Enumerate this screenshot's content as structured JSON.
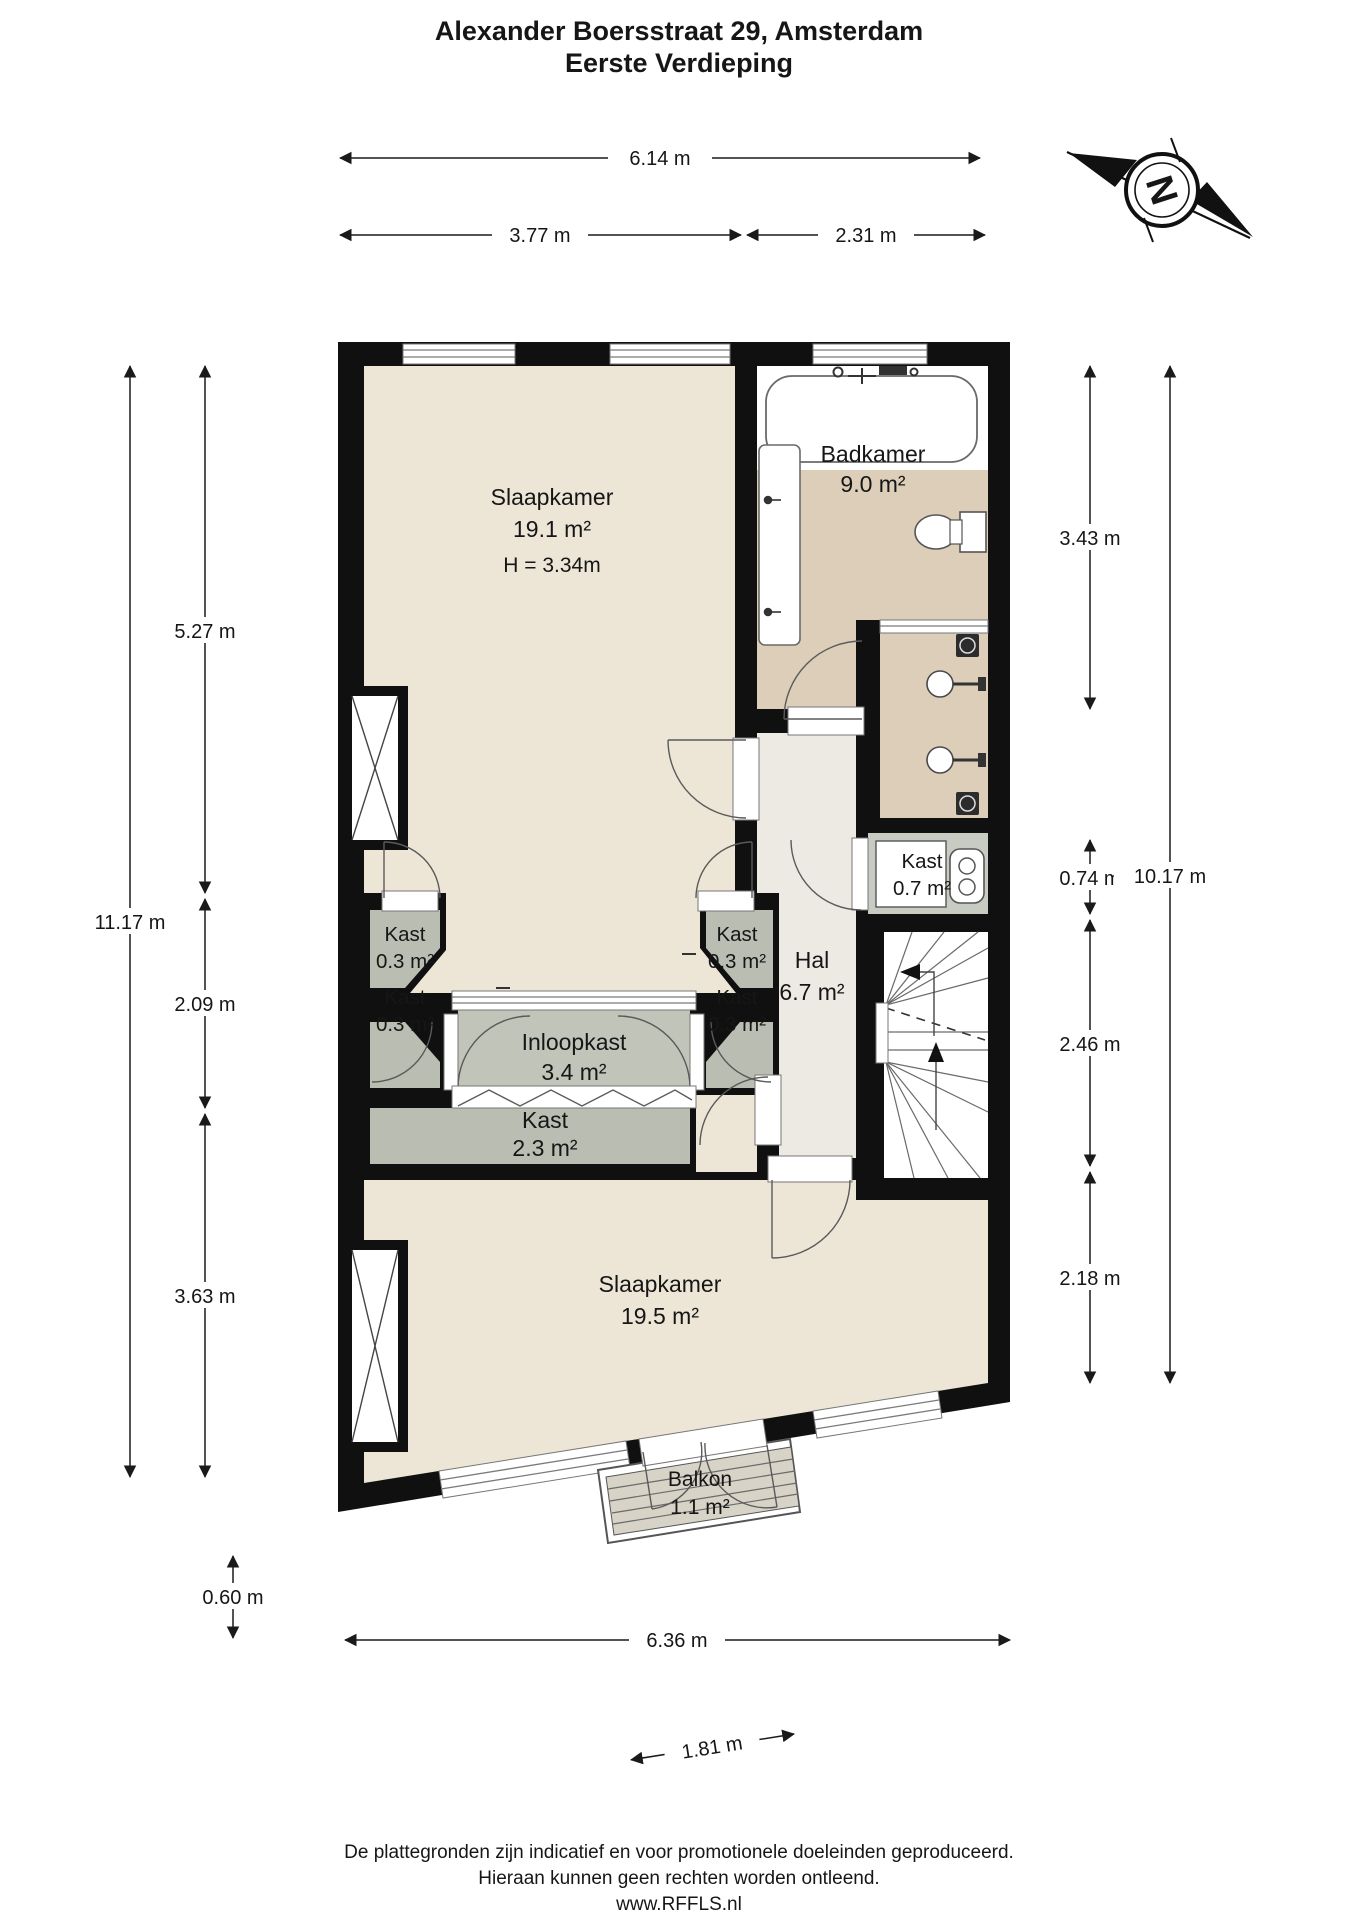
{
  "title": {
    "line1": "Alexander Boersstraat 29, Amsterdam",
    "line2": "Eerste Verdieping"
  },
  "compass": {
    "letter": "N"
  },
  "rooms": {
    "slaapkamer1": {
      "name": "Slaapkamer",
      "area": "19.1 m²",
      "height": "H = 3.34m"
    },
    "badkamer": {
      "name": "Badkamer",
      "area": "9.0 m²"
    },
    "hal": {
      "name": "Hal",
      "area": "6.7 m²"
    },
    "kast_top_left": {
      "name": "Kast",
      "area": "0.3 m²"
    },
    "kast_left_lower": {
      "name": "Kast",
      "area": "0.3 m²"
    },
    "kast_top_right": {
      "name": "Kast",
      "area": "0.3 m²"
    },
    "kast_right_lower": {
      "name": "Kast",
      "area": "0.3 m²"
    },
    "inloopkast": {
      "name": "Inloopkast",
      "area": "3.4 m²"
    },
    "kast_2_3": {
      "name": "Kast",
      "area": "2.3 m²"
    },
    "kast_0_7": {
      "name": "Kast",
      "area": "0.7 m²"
    },
    "slaapkamer2": {
      "name": "Slaapkamer",
      "area": "19.5 m²"
    },
    "balkon": {
      "name": "Balkon",
      "area": "1.1 m²"
    }
  },
  "dimensions": {
    "top_total": "6.14 m",
    "top_left": "3.77 m",
    "top_right": "2.31 m",
    "left_total": "11.17 m",
    "left_seg1": "5.27 m",
    "left_seg2": "2.09 m",
    "left_seg3": "3.63 m",
    "balcony_depth": "0.60 m",
    "right_seg1": "3.43 m",
    "right_seg2": "0.74 m",
    "right_seg3": "2.46 m",
    "right_seg4": "2.18 m",
    "right_total": "10.17 m",
    "bottom_total": "6.36 m",
    "balcony_width": "1.81 m"
  },
  "colors": {
    "wall": "#101010",
    "bedroom_floor": "#EDE6D7",
    "bathroom_floor": "#DCCEB8",
    "hall_floor": "#ECEAE3",
    "closet_floor": "#B9BDB2",
    "walkin_floor": "#C0C4B9",
    "deck": "#D7D3C6"
  },
  "footer": {
    "line1": "De plattegronden zijn indicatief en voor promotionele doeleinden geproduceerd.",
    "line2": "Hieraan kunnen geen rechten worden ontleend.",
    "line3": "www.RFFLS.nl"
  }
}
